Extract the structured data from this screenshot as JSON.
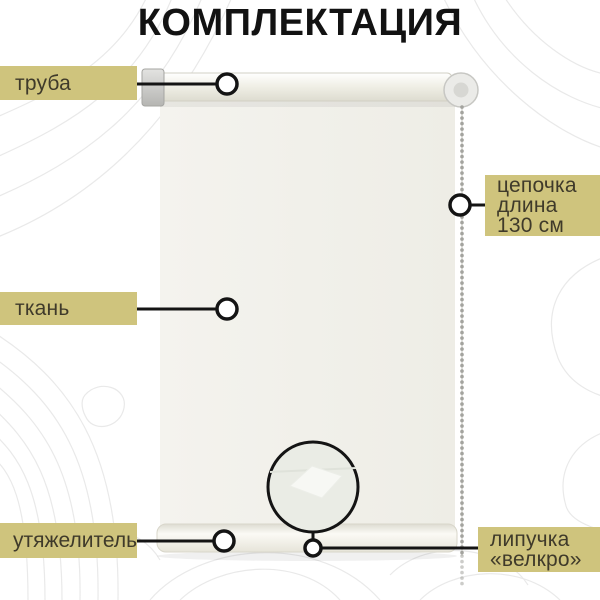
{
  "title": "КОМПЛЕКТАЦИЯ",
  "labels": {
    "tube": {
      "text": "труба"
    },
    "fabric": {
      "text": "ткань"
    },
    "weight": {
      "text": "утяжелитель"
    },
    "chain": {
      "lines": [
        "цепочка",
        "длина",
        "130 см"
      ]
    },
    "velcro": {
      "lines": [
        "липучка",
        "«велкро»"
      ]
    }
  },
  "colors": {
    "label_bg": "#cfc47d",
    "label_text": "#3f3a2a",
    "annotation": "#141414",
    "title_color": "#121212"
  }
}
